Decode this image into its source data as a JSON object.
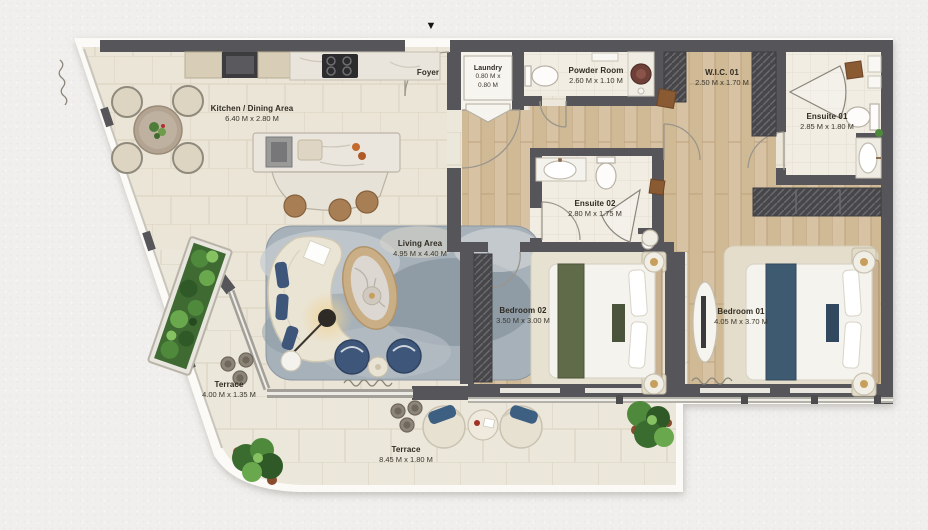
{
  "entry": {
    "marker": "▼"
  },
  "rooms": {
    "kitchen_dining": {
      "name": "Kitchen / Dining Area",
      "dims": "6.40 M x 2.80 M"
    },
    "foyer": {
      "name": "Foyer"
    },
    "laundry": {
      "name": "Laundry",
      "dims_line1": "0.80 M x",
      "dims_line2": "0.80 M"
    },
    "powder_room": {
      "name": "Powder Room",
      "dims": "2.60 M x 1.10 M"
    },
    "wic_01": {
      "name": "W.I.C. 01",
      "dims": "2.50 M x 1.70 M"
    },
    "ensuite_01": {
      "name": "Ensuite 01",
      "dims": "2.85 M x 1.80 M"
    },
    "ensuite_02": {
      "name": "Ensuite 02",
      "dims": "2.80 M x 1.75 M"
    },
    "living_area": {
      "name": "Living Area",
      "dims": "4.95 M x 4.40 M"
    },
    "bedroom_01": {
      "name": "Bedroom 01",
      "dims": "4.05 M x 3.70 M"
    },
    "bedroom_02": {
      "name": "Bedroom 02",
      "dims": "3.50 M x 3.00 M"
    },
    "terrace_side": {
      "name": "Terrace",
      "dims": "4.00 M x 1.35 M"
    },
    "terrace_main": {
      "name": "Terrace",
      "dims": "8.45 M x 1.80 M"
    }
  },
  "palette": {
    "background": "#f0efed",
    "wall": "#56565a",
    "kitchen_tile": "#ebe5d8",
    "terrace_tile": "#ece7db",
    "bath_tile": "#f1ede3",
    "wood_floor": "#d7c3a3",
    "living_rug": "#a7b1b9",
    "bed01_runner": "#3e5a70",
    "bed02_runner": "#5f6b49",
    "accent_navy": "#3d567a",
    "plant_green": "#4f8a3c",
    "stool_brown": "#a87e55",
    "vanity_brown": "#6e4038"
  }
}
